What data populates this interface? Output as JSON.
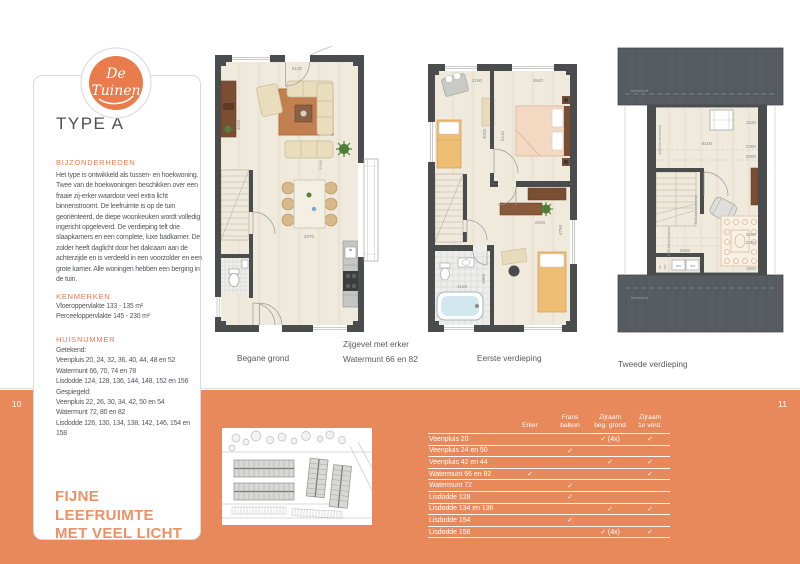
{
  "page": {
    "page_number_left": "10",
    "page_number_right": "11"
  },
  "logo": {
    "word1": "De",
    "word2": "Tuinen"
  },
  "info_card": {
    "title": "TYPE A",
    "bijzonderheden_heading": "BIJZONDERHEDEN",
    "bijzonderheden_text": "Het type is ontwikkeld als tussen- en hoekwoning. Twee van de hoekwoningen beschikken over een fraaie zij-erker waardoor veel extra licht binnenstroomt.  De leefruimte is op de tuin georiënteerd, de diepe woonkeuken wordt volledig ingericht opgeleverd. De verdieping telt drie slaapkamers en een complete, luxe badkamer.  De zolder heeft daglicht door het dakraam aan de achterzijde en is verdeeld in een voorzolder en een grote kamer. Alle woningen hebben een berging in de tuin.",
    "kenmerken_heading": "KENMERKEN",
    "kenmerken_lines": [
      "Vloeroppervlakte 133 - 135 m²",
      "Perceeloppervlakte 145 - 230 m²"
    ],
    "huisnummer_heading": "HUISNUMMER",
    "huisnummer_lines": [
      "Getekend:",
      "Veenpluis 20, 24, 32, 36, 40, 44, 48 en 52",
      "Watermunt 66, 70, 74 en 78",
      "Lisdodde 124, 128, 136, 144, 148, 152 en 156",
      "Gespiegeld:",
      "Veenpluis 22, 26, 30, 34, 42, 50 en 54",
      "Watermunt 72, 80 en 82",
      "Lisdodde 126, 130, 134, 138, 142, 146, 154 en 158"
    ],
    "tagline_line1": "FIJNE LEEFRUIMTE",
    "tagline_line2": "MET VEEL LICHT"
  },
  "captions": {
    "plan1": "Begane grond",
    "zijgevel_line1": "Zijgevel met erker",
    "zijgevel_line2": "Watermunt 66 en 82",
    "plan2": "Eerste verdieping",
    "plan3": "Tweede verdieping"
  },
  "plan1_dims": [
    "5100",
    "4000",
    "2970",
    "0.000"
  ],
  "plan2_dims": [
    "2190",
    "2840",
    "4000",
    "5110",
    "2840",
    "4790",
    "1950",
    "2150"
  ],
  "plan3_dims": [
    "1520",
    "2300",
    "2600",
    "5100",
    "2060 tot knieschot",
    "7640 tot knieschot",
    "1800 tot knieschot",
    "2050",
    "2600",
    "2200",
    "1500"
  ],
  "plan3_labels": {
    "knieschot": "knieschot",
    "wm": "wm",
    "wd": "wd",
    "cv": "cv",
    "mv": "mv"
  },
  "table": {
    "columns": [
      "Erker",
      "Frans\nbalkon",
      "Zijraam\nbeg. grond",
      "Zijraam\n1e verd."
    ],
    "rows": [
      {
        "label": "Veenpluis 20",
        "cells": [
          "",
          "",
          "✓ (4x)",
          "✓"
        ]
      },
      {
        "label": "Veenpluis 24 en 50",
        "cells": [
          "",
          "✓",
          "",
          ""
        ]
      },
      {
        "label": "Veenpluis 42 en 44",
        "cells": [
          "",
          "",
          "✓",
          "✓"
        ]
      },
      {
        "label": "Watermunt 66 en 82",
        "cells": [
          "✓",
          "",
          "",
          "✓"
        ]
      },
      {
        "label": "Watermunt 72",
        "cells": [
          "",
          "✓",
          "",
          ""
        ]
      },
      {
        "label": "Lisdodde 128",
        "cells": [
          "",
          "✓",
          "",
          ""
        ]
      },
      {
        "label": "Lisdodde 134 en 136",
        "cells": [
          "",
          "",
          "✓",
          "✓"
        ]
      },
      {
        "label": "Lisdodde 154",
        "cells": [
          "",
          "✓",
          "",
          ""
        ]
      },
      {
        "label": "Lisdodde 158",
        "cells": [
          "",
          "",
          "✓ (4x)",
          "✓"
        ]
      }
    ]
  },
  "colors": {
    "accent_orange": "#E8895B",
    "logo_orange": "#E97C4C",
    "heading_orange": "#E87C4D",
    "text_dark": "#55565A",
    "wall_gray": "#4B4C4E"
  }
}
